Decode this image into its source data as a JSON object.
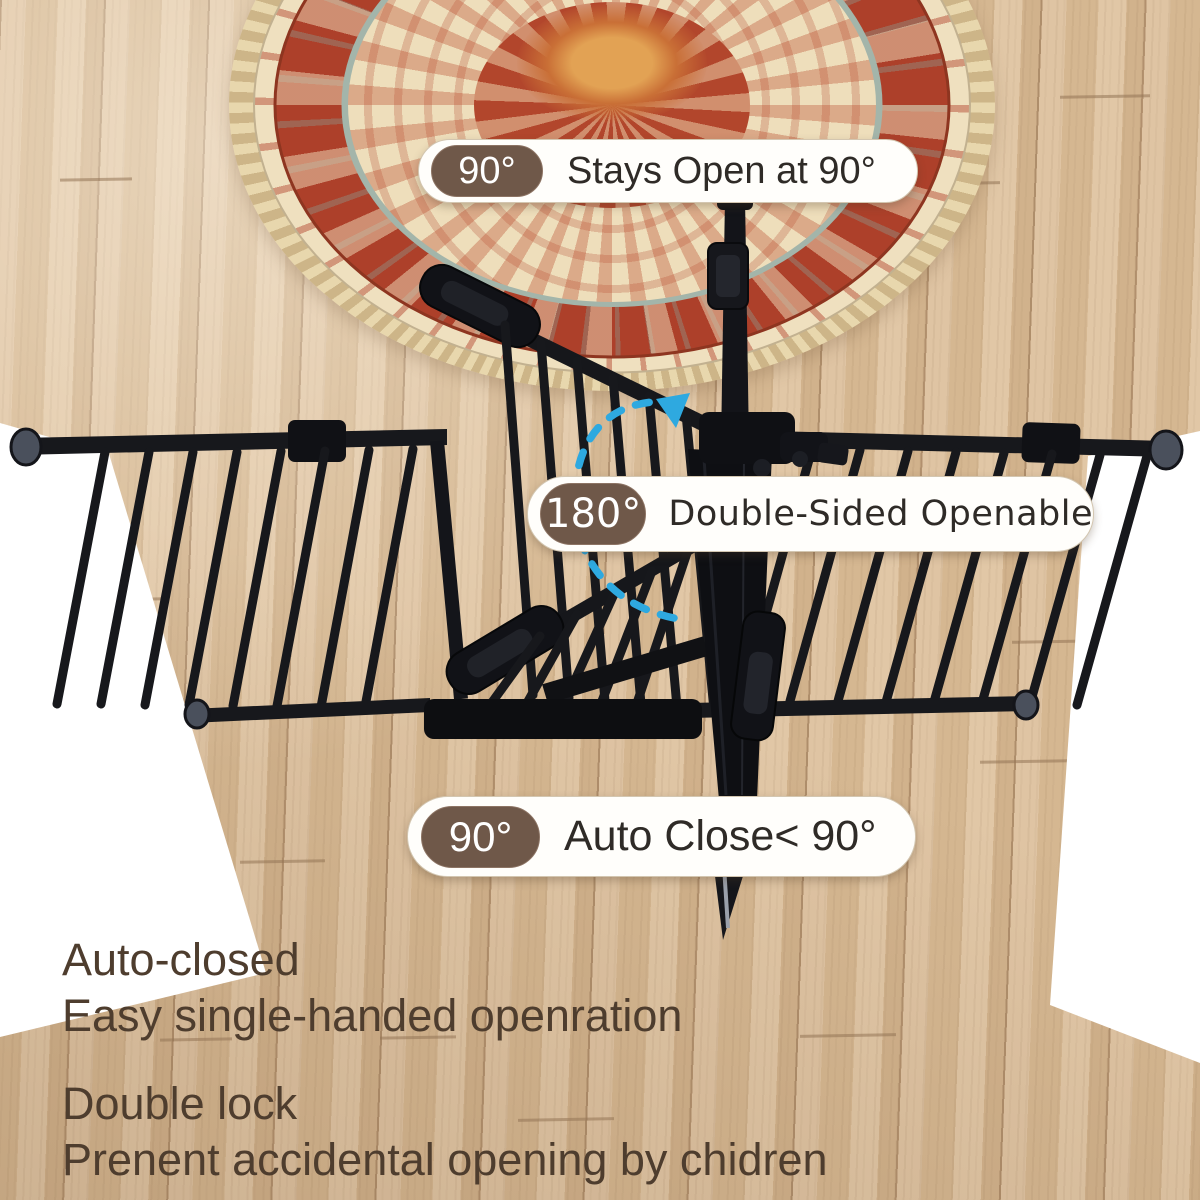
{
  "callouts": {
    "stays_open": {
      "badge": "90°",
      "label": "Stays Open at 90°"
    },
    "double_sided": {
      "badge": "180°",
      "label": "Double-Sided Openable"
    },
    "auto_close": {
      "badge": "90°",
      "label": "Auto Close< 90°"
    }
  },
  "features": {
    "block1": {
      "line1": "Auto-closed",
      "line2": "Easy single-handed openration"
    },
    "block2": {
      "line1": "Double lock",
      "line2": "Prenent accidental opening by chidren"
    }
  },
  "colors": {
    "badge_brown": "#6f5849",
    "pill_white": "#fffefb",
    "pill_label_dark": "#2f2b27",
    "feature_text_brown": "#4e3d2e",
    "gate_black": "#17181c",
    "rotation_arrow_blue": "#2ea9e0",
    "floor_tan": "#d8bc99",
    "wall_white": "#f7f7f7",
    "rug_red": "#ad402a",
    "rug_cream": "#eedebb"
  },
  "icons": {
    "rotation_arrow": "curved-dashed-rotation-arrow"
  }
}
